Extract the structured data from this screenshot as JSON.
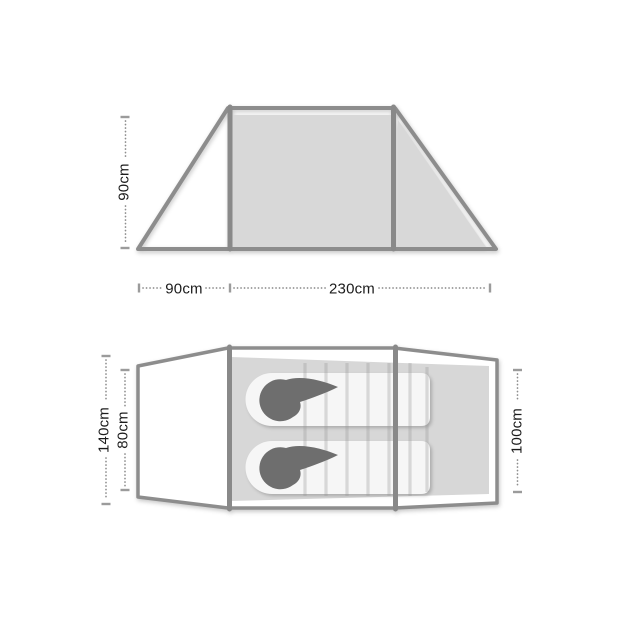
{
  "colors": {
    "background": "#ffffff",
    "outline": "#8d8d8d",
    "pole": "#898989",
    "panel_fill": "#d8d8d8",
    "floor_fill": "#d7d7d7",
    "sleeping_bag_fill": "#f6f6f6",
    "hood_fill": "#6e6e6e",
    "dimension_tick": "#9b9b9b",
    "dimension_dots": "#8e8e8e"
  },
  "side_view": {
    "height_label": "90cm",
    "porch_length_label": "90cm",
    "inner_length_label": "230cm"
  },
  "floor_plan": {
    "max_width_label": "140cm",
    "inner_width_label": "80cm",
    "door_end_width_label": "100cm"
  }
}
